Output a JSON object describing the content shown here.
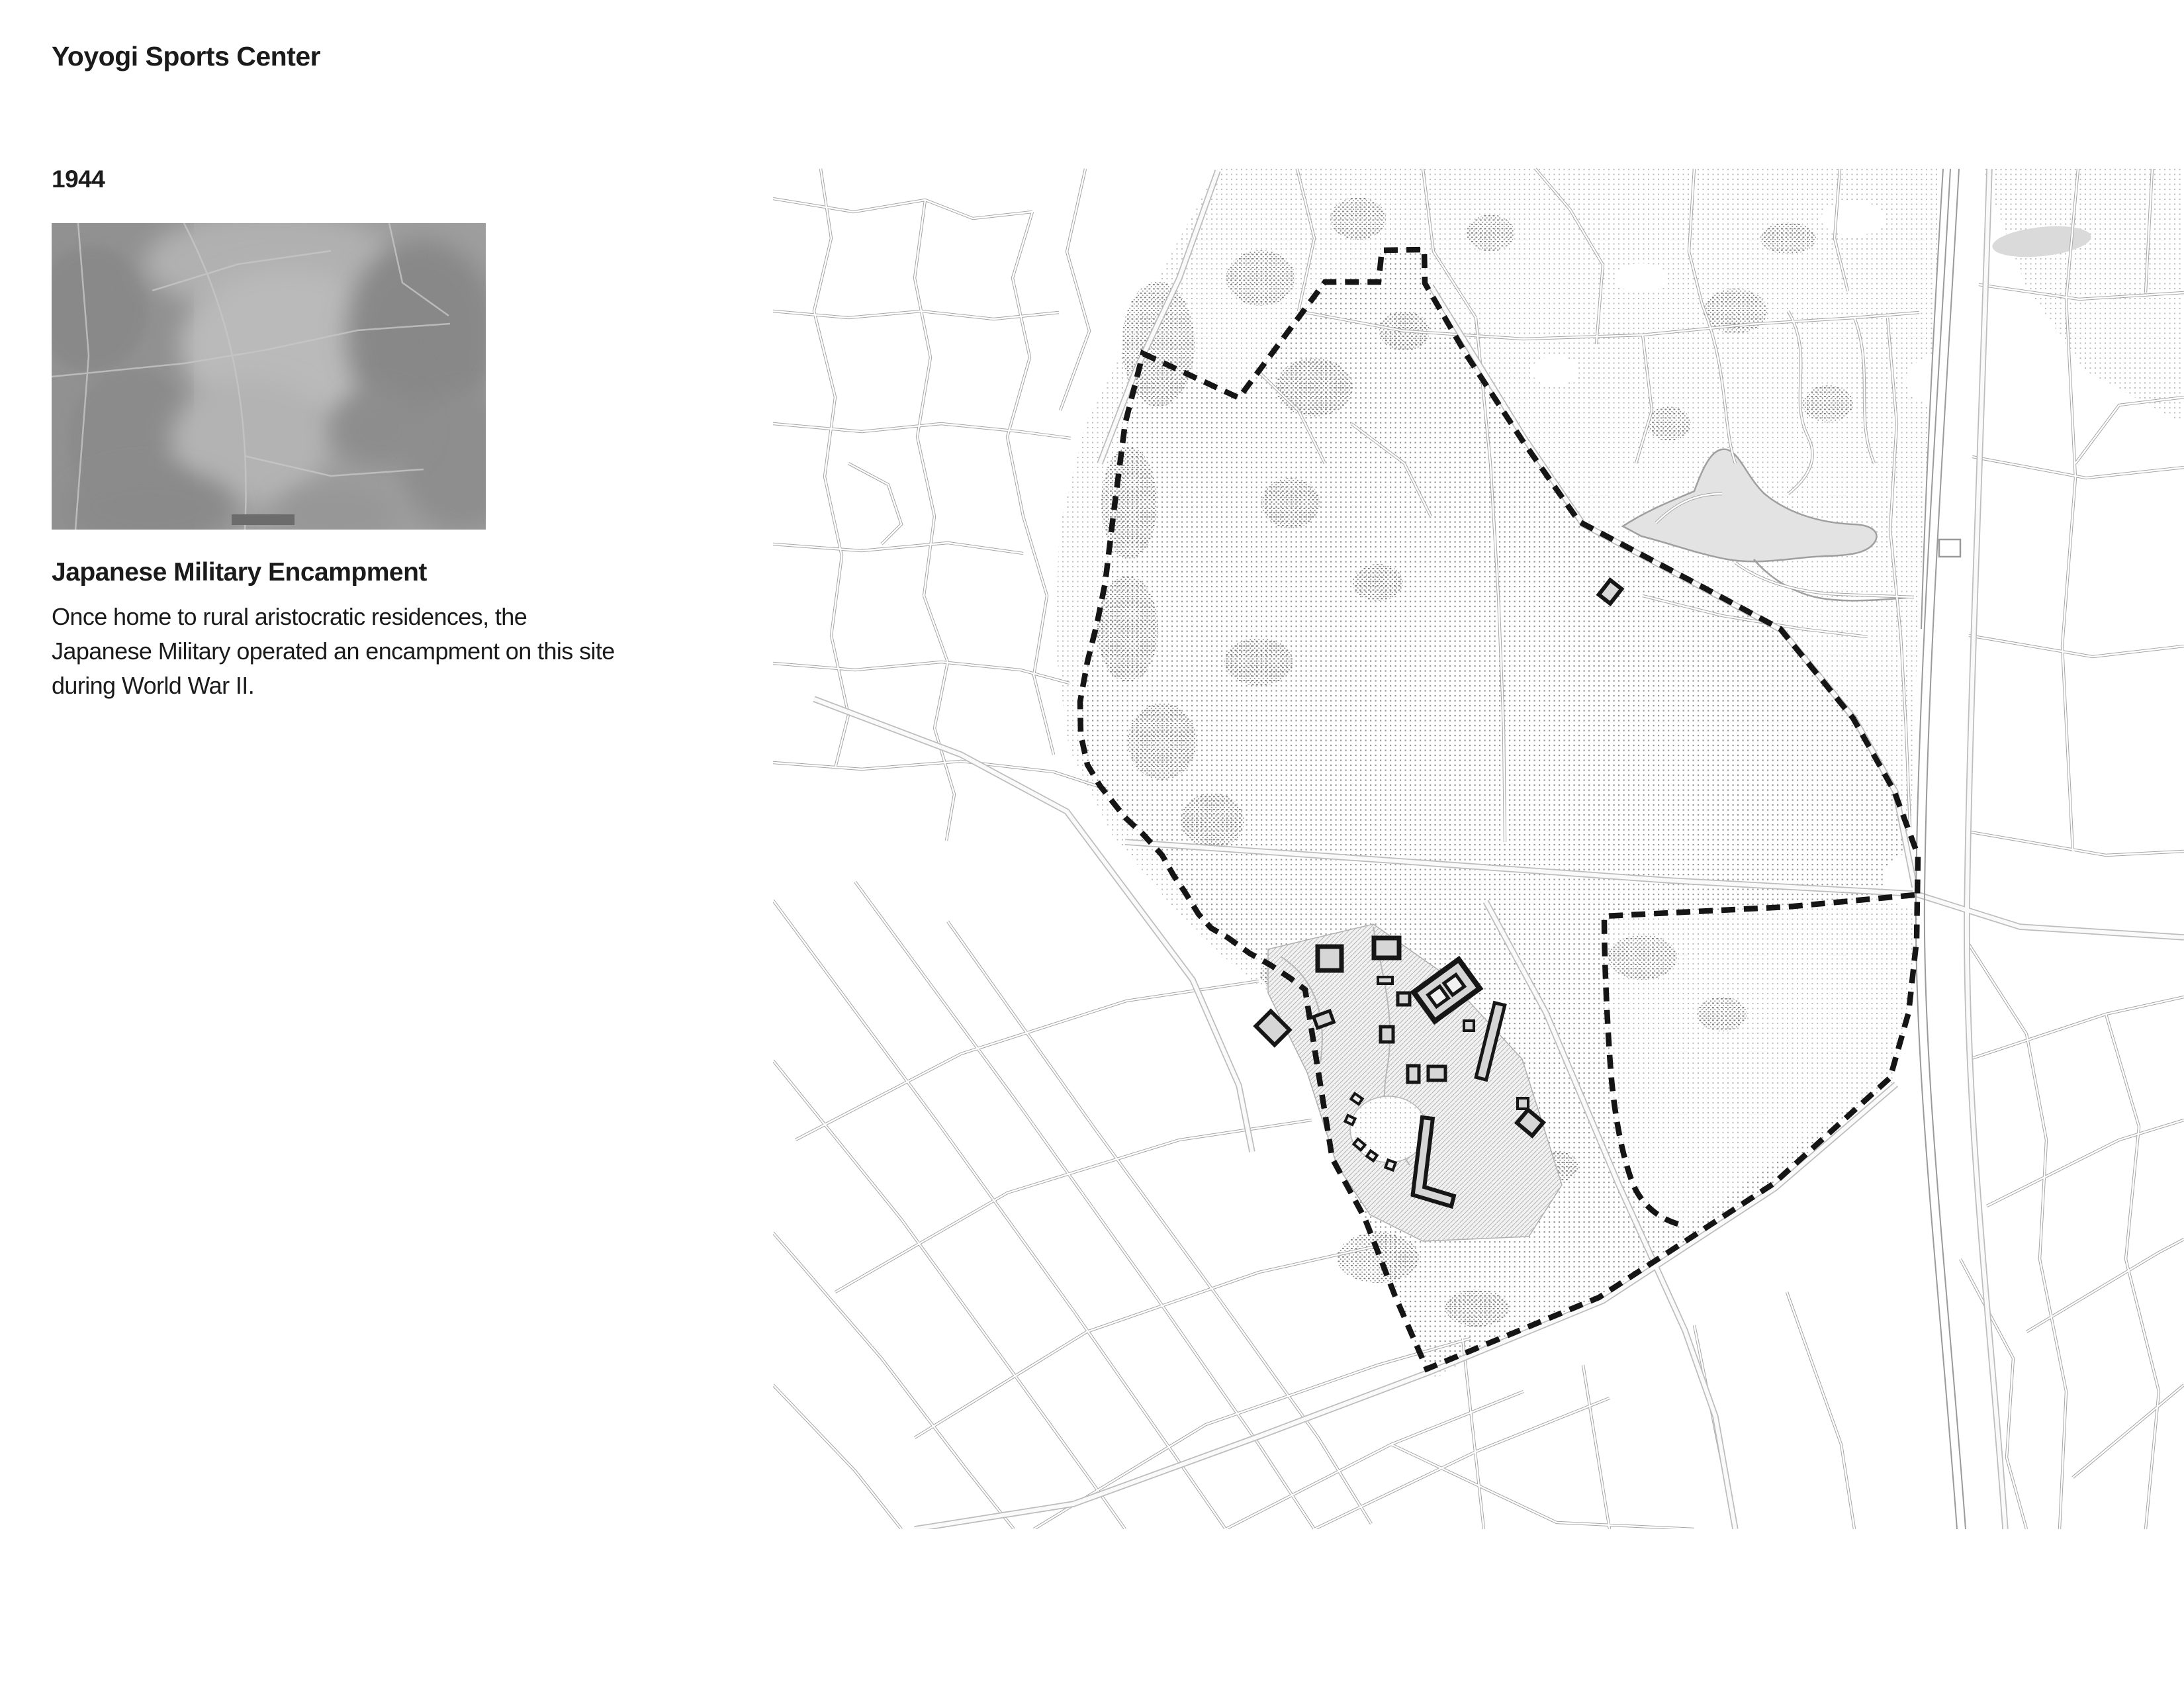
{
  "header": {
    "title": "Yoyogi Sports Center"
  },
  "timeline": {
    "year": "1944"
  },
  "photo": {
    "alt": "Aerial photograph of the Yoyogi site, 1944"
  },
  "article": {
    "heading": "Japanese Military Encampment",
    "body_lines": [
      "Once home to rural aristocratic residences, the",
      "Japanese Military operated an encampment on this site",
      "during World War II."
    ]
  },
  "map": {
    "subject": "Site plan of the Yoyogi site with dashed boundary",
    "colors": {
      "boundary": "#151515",
      "street": "#a6a6a6",
      "park_dot_light": "#bdbdbd",
      "park_dot_dark": "#979797",
      "stipple_dark": "#7d7d7d",
      "water_fill": "#e3e3e3",
      "building_fill": "#d6d6d6",
      "building_outline": "#161616"
    }
  }
}
